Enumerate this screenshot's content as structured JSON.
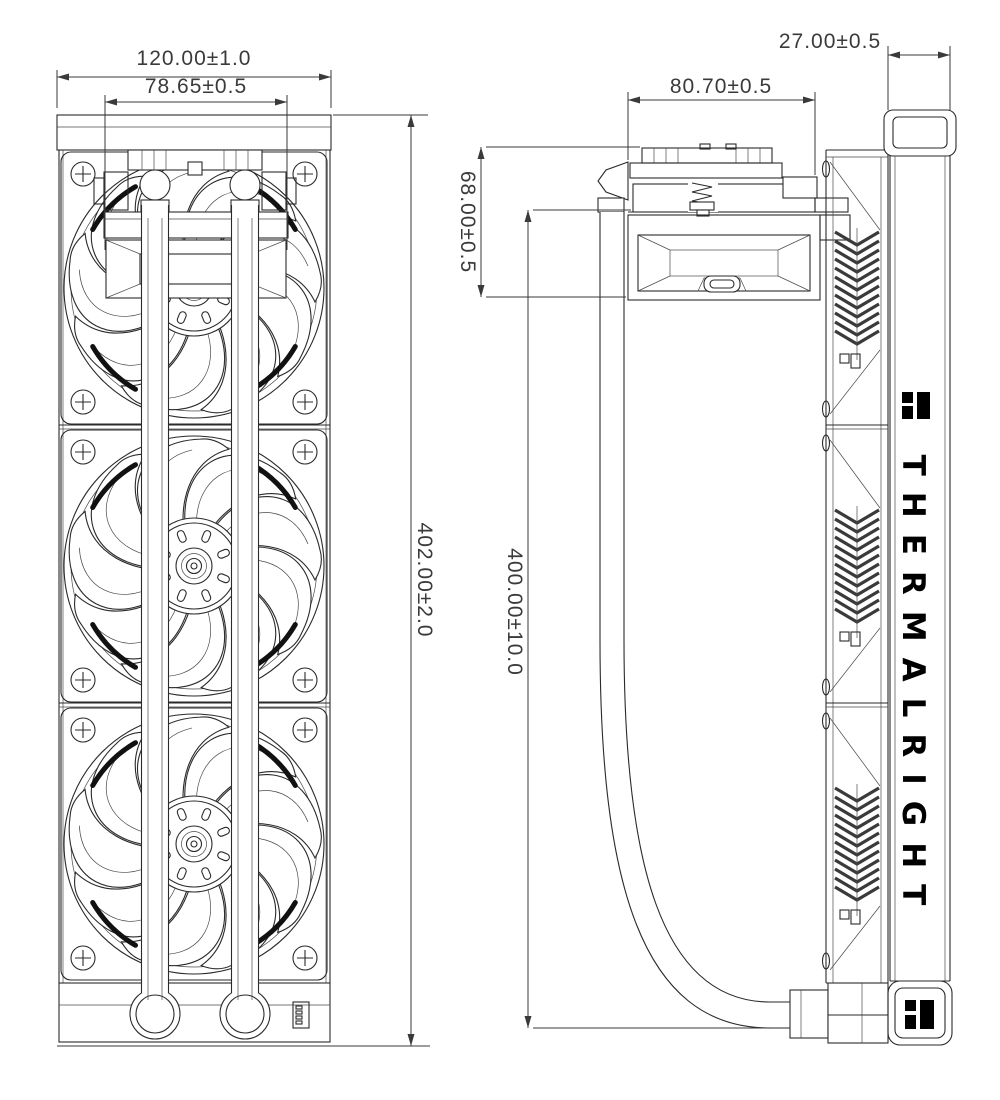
{
  "drawing": {
    "brand": "THERMALRIGHT",
    "line_color": "#2a2a2a",
    "dim_color": "#3a3a3a",
    "front_view": {
      "radiator_width_dim": "120.00±1.0",
      "mount_width_dim": "78.65±0.5",
      "radiator_length_dim": "402.00±2.0"
    },
    "side_view": {
      "pump_width_dim": "80.70±0.5",
      "pump_height_dim": "68.00±0.5",
      "tube_length_dim": "400.00±10.0",
      "radiator_thickness_dim": "27.00±0.5"
    }
  }
}
